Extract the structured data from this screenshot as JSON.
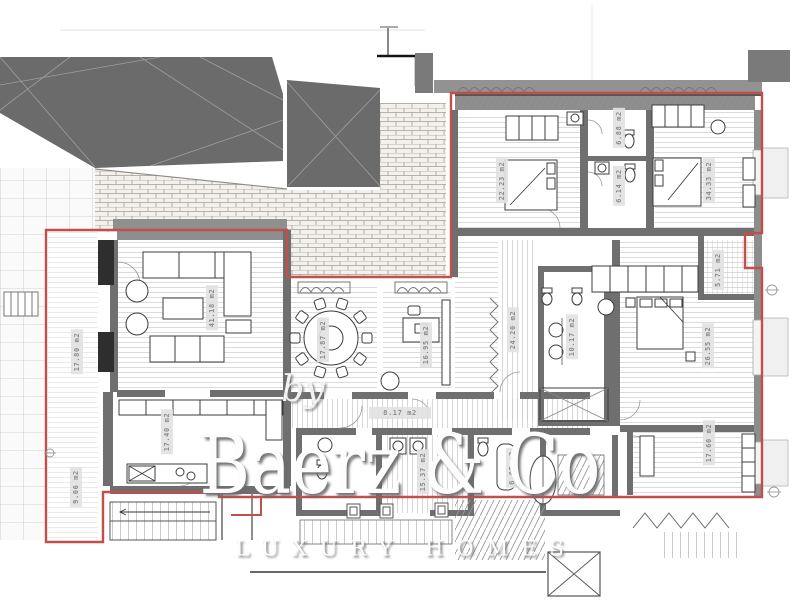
{
  "watermark": {
    "by": "by",
    "brand": "Baerz & Co",
    "tagline": "LUXURY HOMES"
  },
  "rooms": [
    {
      "name": "terrace-west",
      "area": "17.80 m2"
    },
    {
      "name": "terrace-south",
      "area": "9.06 m2"
    },
    {
      "name": "living-room",
      "area": "41.18 m2"
    },
    {
      "name": "dining-room",
      "area": "17.87 m2"
    },
    {
      "name": "kitchen",
      "area": "17.40 m2"
    },
    {
      "name": "study",
      "area": "16.95 m2"
    },
    {
      "name": "corridor",
      "area": "8.17 m2"
    },
    {
      "name": "hallway",
      "area": "24.20 m2"
    },
    {
      "name": "master-bathroom",
      "area": "10.17 m2"
    },
    {
      "name": "master-bedroom",
      "area": "26.55 m2"
    },
    {
      "name": "bedroom-2",
      "area": "22.23 m2"
    },
    {
      "name": "bathroom-2",
      "area": "6.88 m2"
    },
    {
      "name": "bathroom-3",
      "area": "6.14 m2"
    },
    {
      "name": "bedroom-3",
      "area": "34.33 m2"
    },
    {
      "name": "closet",
      "area": "5.71 m2"
    },
    {
      "name": "laundry",
      "area": "15.37 m2"
    },
    {
      "name": "bathroom-4",
      "area": "6.05 m2"
    },
    {
      "name": "bedroom-4",
      "area": "17.60 m2"
    }
  ],
  "colors": {
    "boundary": "#c0504a",
    "roof_fill": "#6b6b6b",
    "wall_fill": "#8d8d8d",
    "label_bg": "#e4e4e4",
    "label_text": "#8b8b8b",
    "watermark_shadow": "#8a8a8a"
  }
}
